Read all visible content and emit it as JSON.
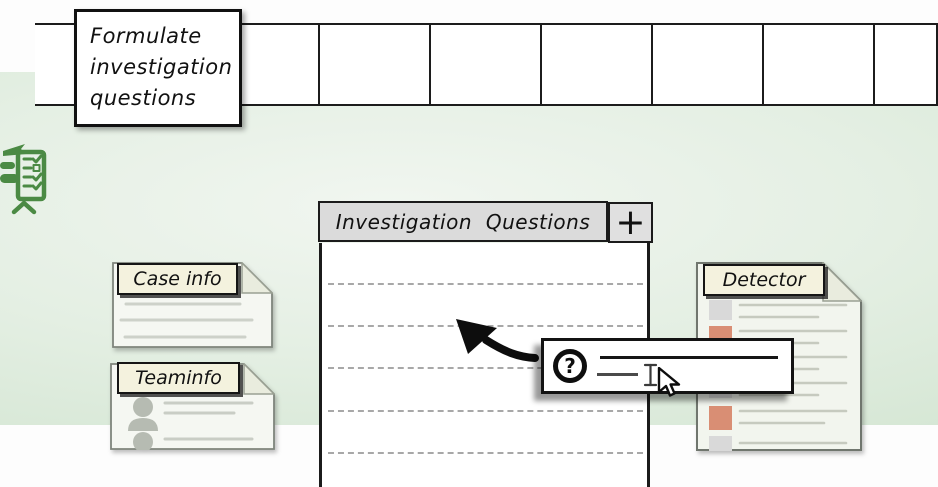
{
  "note": {
    "lines": [
      "Formulate",
      "investigation",
      "questions"
    ]
  },
  "timeline": {
    "step_count": 9
  },
  "panel": {
    "title": "Investigation Questions",
    "add_button_label": "+",
    "ruled_line_count": 5
  },
  "cards": {
    "case_info": {
      "label": "Case info",
      "placeholder_line_count": 3
    },
    "team_info": {
      "label": "Teaminfo",
      "member_count": 2
    },
    "detector": {
      "label": "Detector",
      "row_count": 6
    }
  },
  "help_popup": {
    "icon_label": "?",
    "input_value": ""
  },
  "icons": {
    "clipboard": "checklist-clipboard-icon",
    "question": "question-mark-icon",
    "pointer": "mouse-pointer-icon",
    "text_cursor": "text-cursor-icon",
    "arrow": "annotation-arrow-icon"
  },
  "colors": {
    "background_green": "#cfe3ce",
    "accent_green": "#4b8a44",
    "salmon": "#d98e74",
    "header_gray": "#dbdbdb",
    "label_cream": "#f4f2de",
    "card_bg": "#f5f7f2"
  }
}
